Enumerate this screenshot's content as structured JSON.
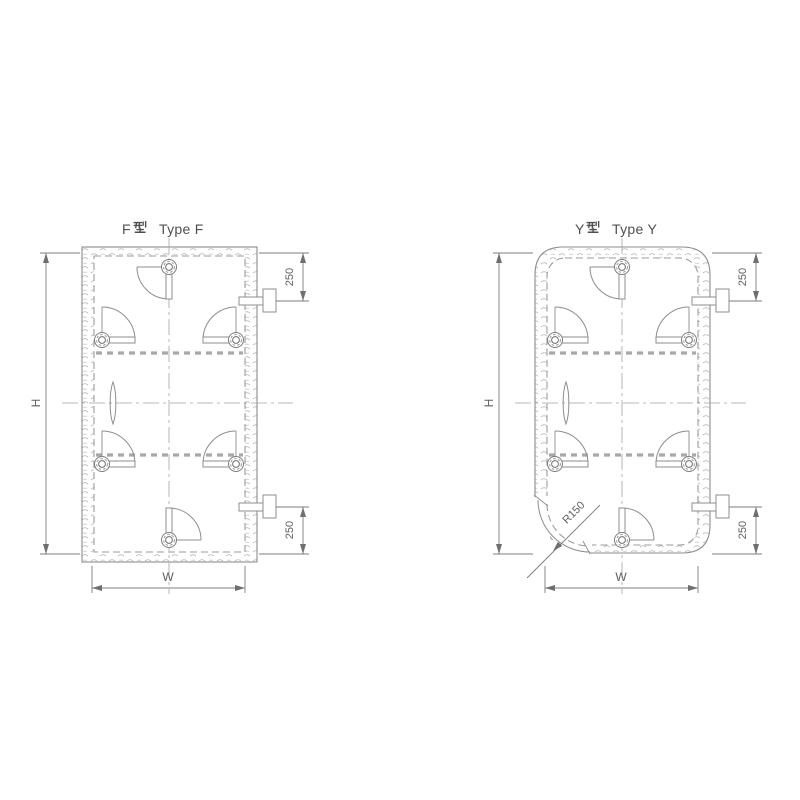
{
  "colors": {
    "line": "#8d8d8d",
    "dim": "#7c7c7c",
    "text": "#4f4f4f",
    "dim_text": "#5f5f5f",
    "hatch": "#b8b8b8",
    "dash": "#9b9b9b",
    "gasket": "#a8a8a8",
    "centerline": "#a3a3a3",
    "arrow": "#6f6f6f",
    "bg": "#ffffff"
  },
  "doors": {
    "f": {
      "title": "F型 Type F",
      "title_prefix": "F",
      "title_suffix": "Type F",
      "dims": {
        "height": "H",
        "width": "W",
        "top_offset": "250",
        "bottom_offset": "250"
      }
    },
    "y": {
      "title": "Y型 Type Y",
      "title_prefix": "Y",
      "title_suffix": "Type Y",
      "dims": {
        "height": "H",
        "width": "W",
        "top_offset": "250",
        "bottom_offset": "250",
        "corner_radius": "R150"
      }
    }
  }
}
